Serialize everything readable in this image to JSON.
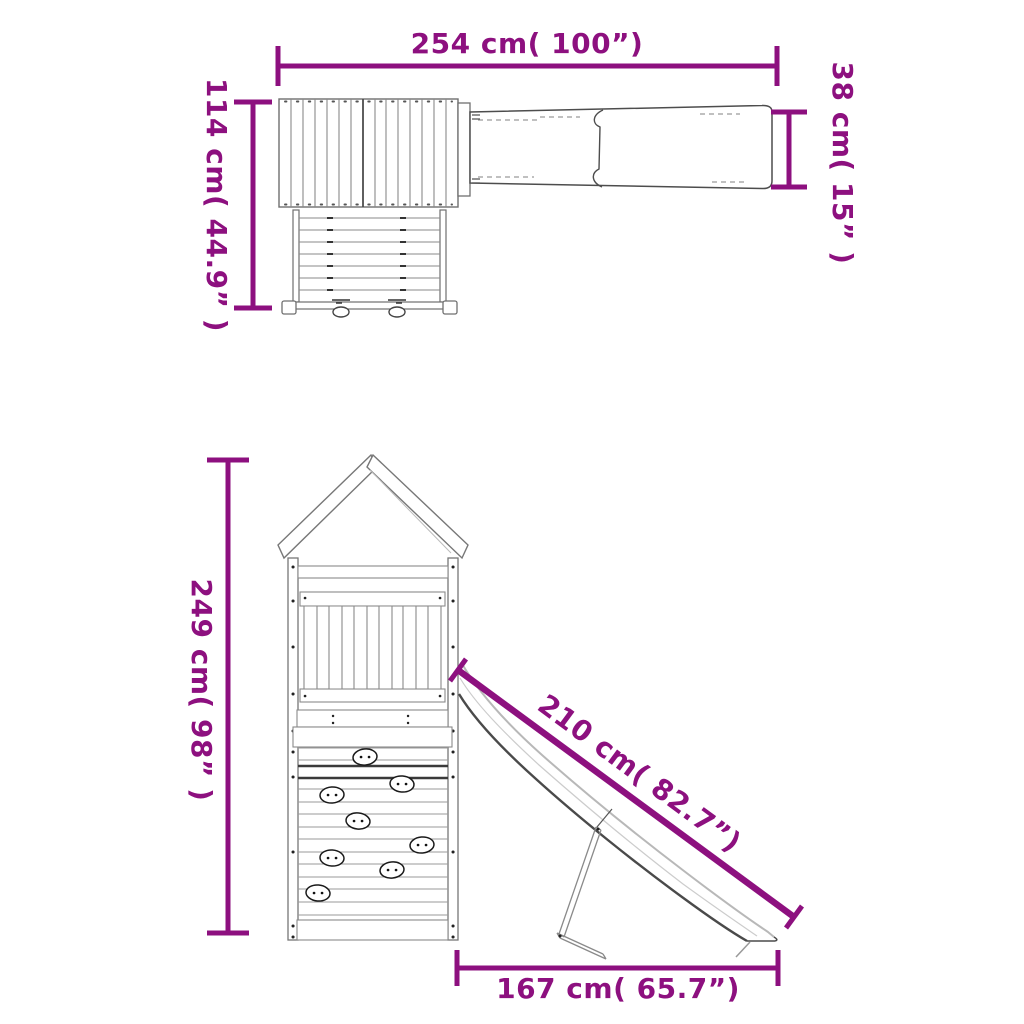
{
  "accent_color": "#8D107F",
  "views": {
    "top": {
      "dimensions": {
        "width": {
          "label": "254 cm( 100”)",
          "cm": 254,
          "inches": 100
        },
        "depth": {
          "label": "114 cm( 44.9” )",
          "cm": 114,
          "inches": 44.9
        },
        "slide_width": {
          "label": "38 cm( 15” )",
          "cm": 38,
          "inches": 15
        }
      }
    },
    "front": {
      "dimensions": {
        "height": {
          "label": "249 cm( 98” )",
          "cm": 249,
          "inches": 98
        },
        "slide_length": {
          "label": "210 cm( 82.7”)",
          "cm": 210,
          "inches": 82.7
        },
        "slide_footprint": {
          "label": "167 cm( 65.7”)",
          "cm": 167,
          "inches": 65.7
        }
      }
    }
  }
}
